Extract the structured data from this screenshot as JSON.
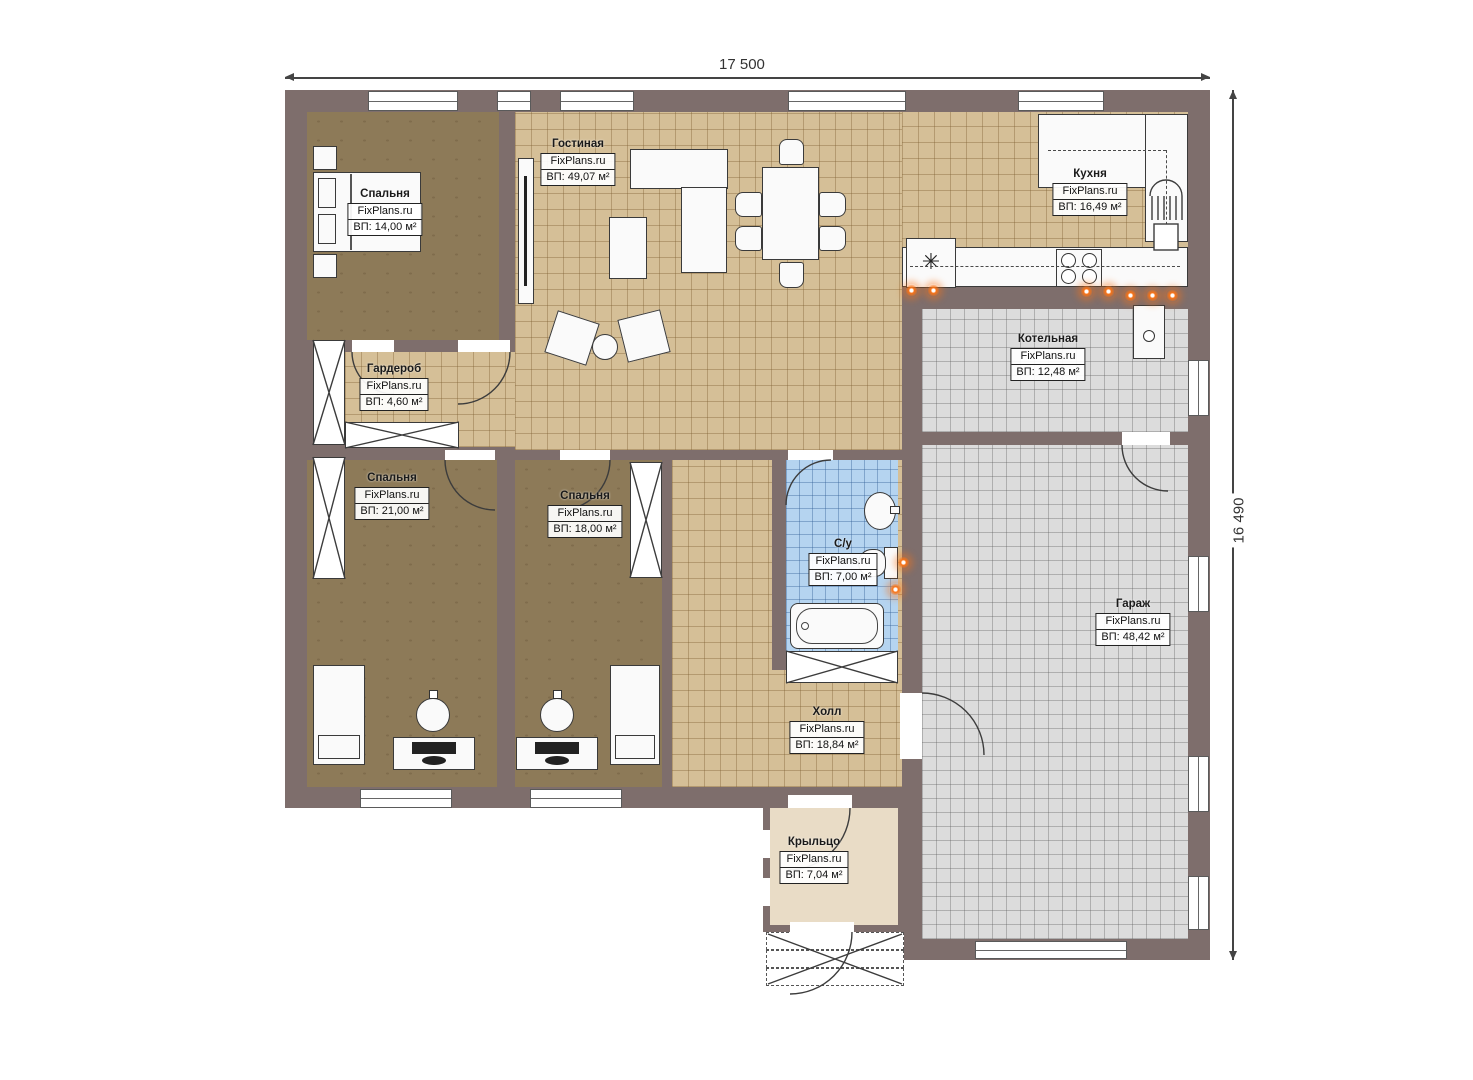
{
  "plan": {
    "dim_width": "17 500",
    "dim_height": "16 490",
    "fridge_symbol": "✳"
  },
  "rooms": [
    {
      "id": "bedroom-1",
      "name": "Спальня",
      "brand": "FixPlans.ru",
      "area": "ВП: 14,00 м²"
    },
    {
      "id": "living-room",
      "name": "Гостиная",
      "brand": "FixPlans.ru",
      "area": "ВП: 49,07 м²"
    },
    {
      "id": "kitchen",
      "name": "Кухня",
      "brand": "FixPlans.ru",
      "area": "ВП: 16,49 м²"
    },
    {
      "id": "wardrobe",
      "name": "Гардероб",
      "brand": "FixPlans.ru",
      "area": "ВП: 4,60 м²"
    },
    {
      "id": "boiler-room",
      "name": "Котельная",
      "brand": "FixPlans.ru",
      "area": "ВП: 12,48 м²"
    },
    {
      "id": "bedroom-2",
      "name": "Спальня",
      "brand": "FixPlans.ru",
      "area": "ВП: 21,00 м²"
    },
    {
      "id": "bedroom-3",
      "name": "Спальня",
      "brand": "FixPlans.ru",
      "area": "ВП: 18,00 м²"
    },
    {
      "id": "bathroom",
      "name": "С/у",
      "brand": "FixPlans.ru",
      "area": "ВП: 7,00 м²"
    },
    {
      "id": "garage",
      "name": "Гараж",
      "brand": "FixPlans.ru",
      "area": "ВП: 48,42 м²"
    },
    {
      "id": "hall",
      "name": "Холл",
      "brand": "FixPlans.ru",
      "area": "ВП: 18,84 м²"
    },
    {
      "id": "porch",
      "name": "Крыльцо",
      "brand": "FixPlans.ru",
      "area": "ВП: 7,04 м²"
    }
  ],
  "colors": {
    "wall": "#7e6e6c",
    "floor_tile_beige": "#d5bf97",
    "floor_brown": "#8d7a58",
    "floor_gray": "#dcdcdc",
    "floor_blue": "#b5d4f0",
    "floor_porch": "#e9dcc6",
    "radiator_orange": "#f97316"
  }
}
